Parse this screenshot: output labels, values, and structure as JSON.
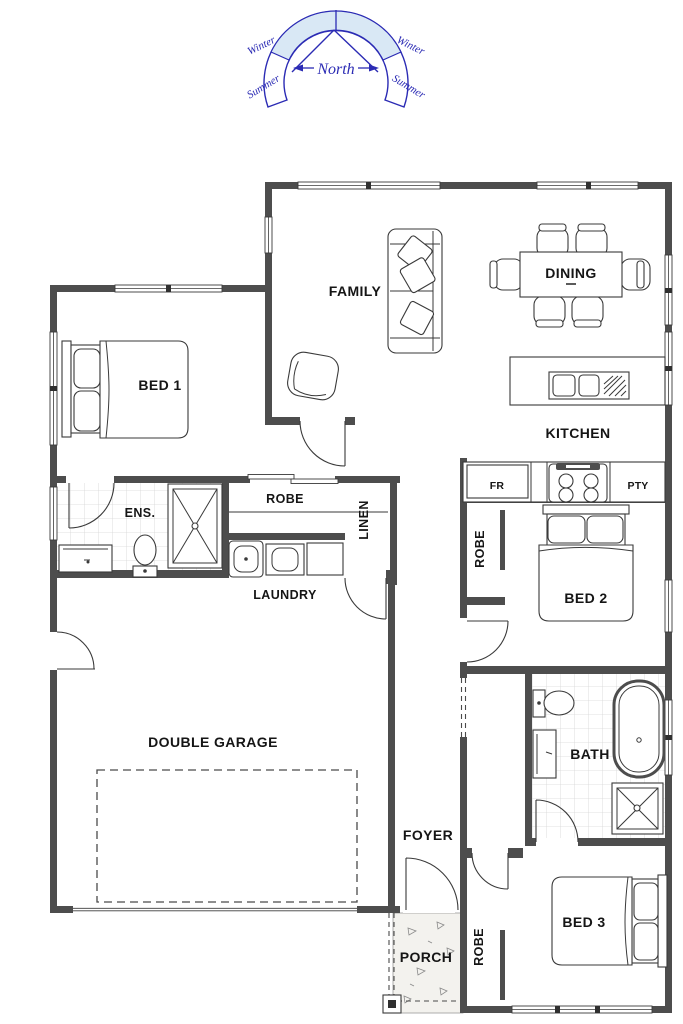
{
  "compass": {
    "north": "North",
    "winter": "Winter",
    "summer": "Summer"
  },
  "rooms": {
    "family": "FAMILY",
    "dining": "DINING",
    "kitchen": "KITCHEN",
    "bed1": "BED 1",
    "bed2": "BED 2",
    "bed3": "BED 3",
    "bath": "BATH",
    "ens": "ENS.",
    "robe": "ROBE",
    "linen": "LINEN",
    "laundry": "LAUNDRY",
    "garage": "DOUBLE GARAGE",
    "foyer": "FOYER",
    "porch": "PORCH",
    "fridge": "FR",
    "pantry": "PTY"
  },
  "colors": {
    "wall": "#4d4d4d",
    "line": "#3a3a3a",
    "compass_blue": "#2b2bb4",
    "compass_fill": "#d9e8f5",
    "tile": "#d6d6d6",
    "concrete": "#f3f2ee"
  }
}
